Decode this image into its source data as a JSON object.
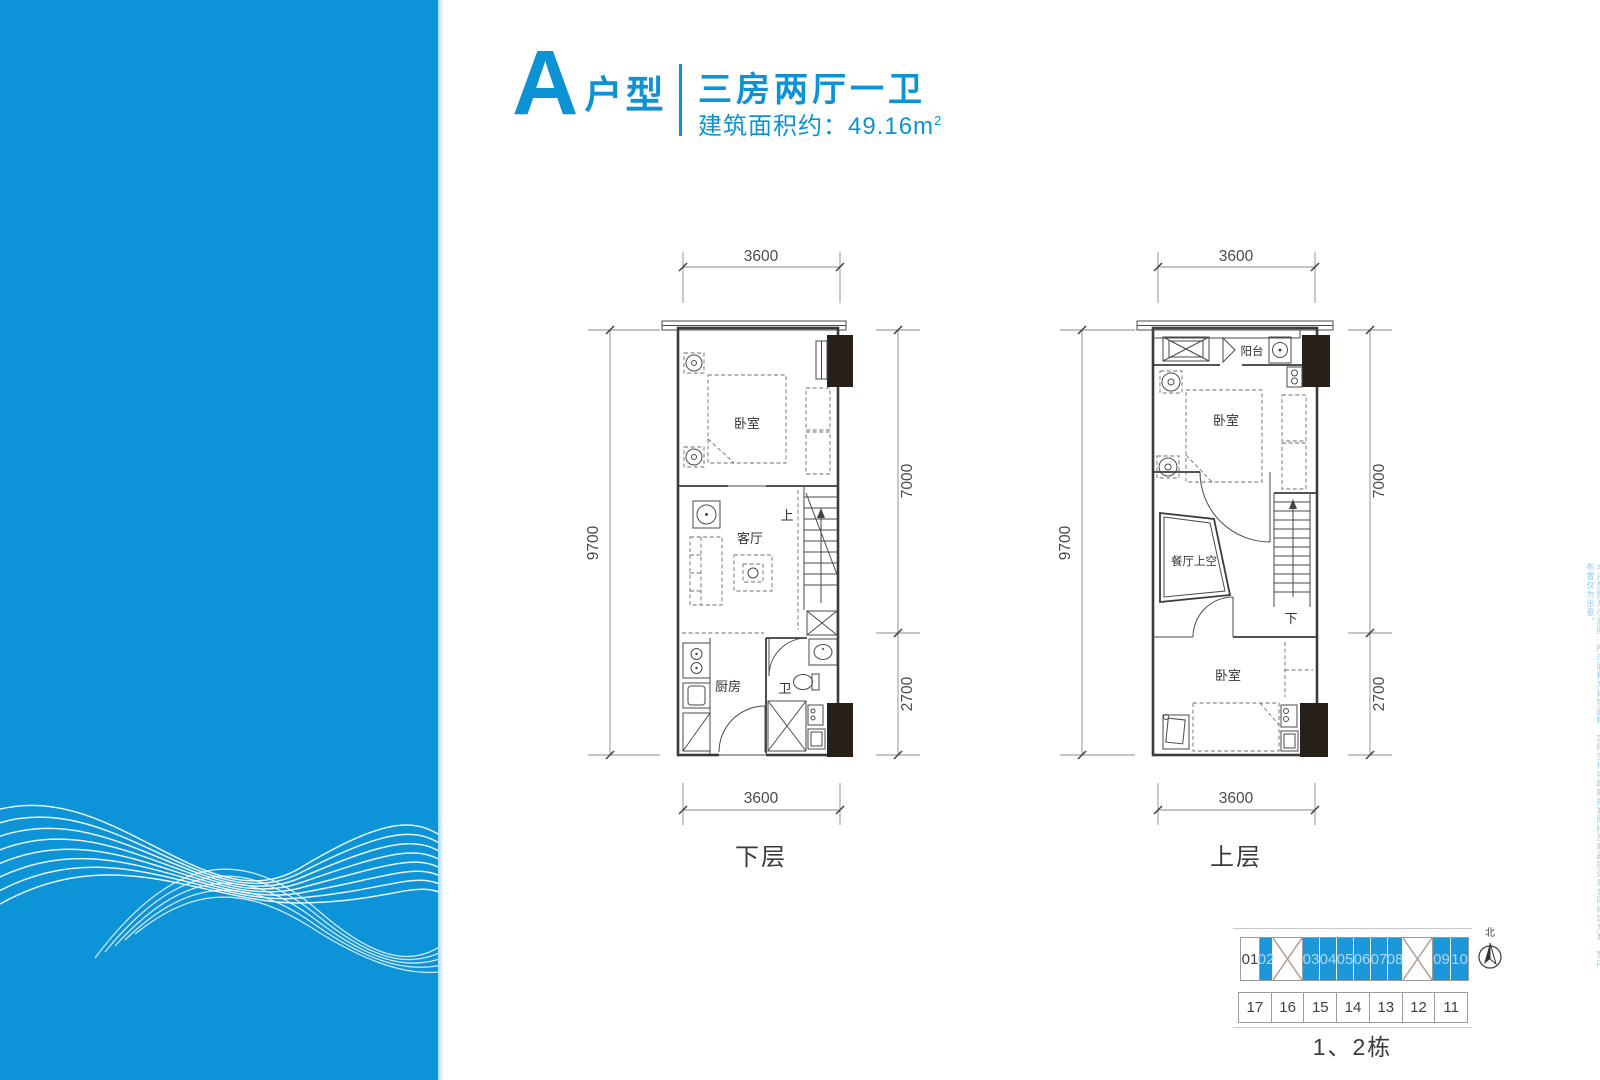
{
  "header": {
    "unit_letter": "A",
    "unit_suffix": "户型",
    "layout_title": "三房两厅一卫",
    "area_prefix": "建筑面积约：49.16m",
    "area_exponent": "2"
  },
  "floor_plans": {
    "lower": {
      "caption": "下层",
      "dim_top": "3600",
      "dim_bottom": "3600",
      "dim_left": "9700",
      "dim_right_main": "7000",
      "dim_right_sub": "2700",
      "room_bedroom": "卧室",
      "room_living": "客厅",
      "room_kitchen": "厨房",
      "room_bath": "卫",
      "stair_label": "上"
    },
    "upper": {
      "caption": "上层",
      "dim_top": "3600",
      "dim_bottom": "3600",
      "dim_left": "9700",
      "dim_right_main": "7000",
      "dim_right_sub": "2700",
      "room_balcony": "阳台",
      "room_bedroom": "卧室",
      "room_void": "餐厅上空",
      "room_bedroom2": "卧室",
      "stair_label": "下"
    }
  },
  "site_plan": {
    "top_row": [
      "01",
      "02",
      "",
      "03",
      "04",
      "05",
      "06",
      "07",
      "08",
      "",
      "09",
      "10"
    ],
    "bottom_row": [
      "17",
      "16",
      "15",
      "14",
      "13",
      "12",
      "11"
    ],
    "caption": "1、2栋",
    "compass_label": "北"
  },
  "disclaimer": "本户型图为示意图，所示面积为建筑面积，实际交付以政府批准图纸及商品房买卖合同约定为准，室内布置仅为示意。",
  "colors": {
    "brand_blue": "#0d93d3",
    "sidebar_blue": "#0d93d8",
    "cell_blue": "#1b97da",
    "plan_lower_fill": "#e9f0f6",
    "plan_upper_fill": "#faf8e1",
    "black_block": "#262019"
  }
}
